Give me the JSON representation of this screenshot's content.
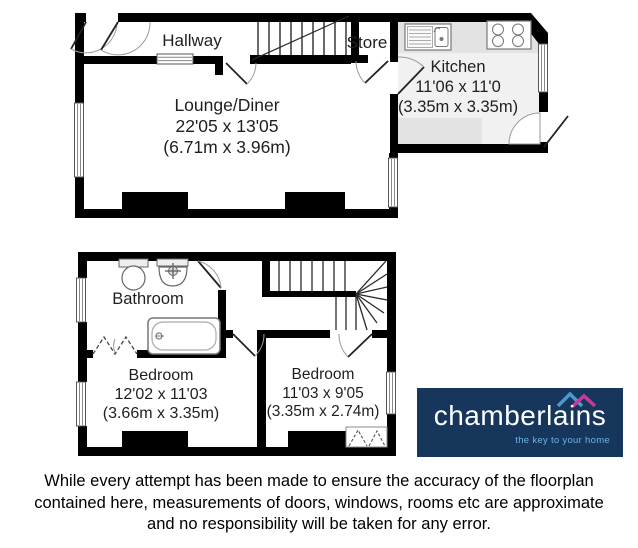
{
  "floorplan": {
    "ground_floor": {
      "hallway": {
        "name": "Hallway"
      },
      "store": {
        "name": "Store"
      },
      "kitchen": {
        "name": "Kitchen",
        "dims_imperial": "11'06 x 11'0",
        "dims_metric": "(3.35m x 3.35m)"
      },
      "lounge": {
        "name": "Lounge/Diner",
        "dims_imperial": "22'05 x 13'05",
        "dims_metric": "(6.71m x 3.96m)"
      }
    },
    "first_floor": {
      "bathroom": {
        "name": "Bathroom"
      },
      "bedroom1": {
        "name": "Bedroom",
        "dims_imperial": "12'02 x 11'03",
        "dims_metric": "(3.66m x 3.35m)"
      },
      "bedroom2": {
        "name": "Bedroom",
        "dims_imperial": "11'03 x 9'05",
        "dims_metric": "(3.35m x 2.74m)"
      }
    },
    "wall_color": "#000000",
    "kitchen_floor_color": "#f1f1f1",
    "kitchen_counter_color": "#e3e3e3"
  },
  "logo": {
    "brand": "chamberlains",
    "tagline": "the key to your home",
    "background_color": "#16365c",
    "brand_color": "#ffffff",
    "tagline_color": "#6fb3e3",
    "roof_left_color": "#4f97d0",
    "roof_right_color": "#c93a96"
  },
  "disclaimer": {
    "line1": "While every attempt has been made to ensure the accuracy of the floorplan",
    "line2": "contained here, measurements of doors, windows, rooms etc are approximate",
    "line3": "and no responsibility will be taken for any error."
  }
}
